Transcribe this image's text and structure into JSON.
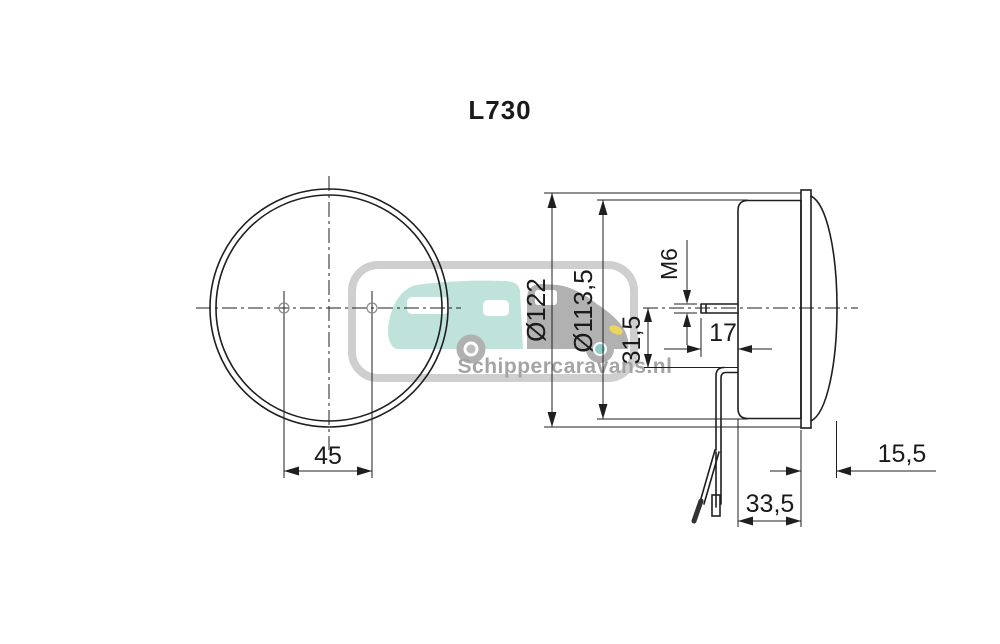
{
  "title": "L730",
  "front_view": {
    "hole_spacing": "45"
  },
  "side_view": {
    "outer_diameter": "Ø122",
    "body_diameter": "Ø113,5",
    "cable_offset": "31,5",
    "thread_size": "M6",
    "stud_length": "17",
    "lens_depth": "15,5",
    "body_depth": "33,5"
  },
  "watermark": {
    "brand": "Schippercaravans.nl"
  },
  "colors": {
    "line": "#1f1f1f",
    "dim_text": "#1a1a1a",
    "watermark_frame": "#cacaca",
    "caravan": "#b9dfd8",
    "car": "#a9a9a9",
    "headlight": "#ecd24d",
    "wheel_hub": "#7fcac3",
    "watermark_text": "#9b9b9b",
    "background": "#ffffff"
  }
}
